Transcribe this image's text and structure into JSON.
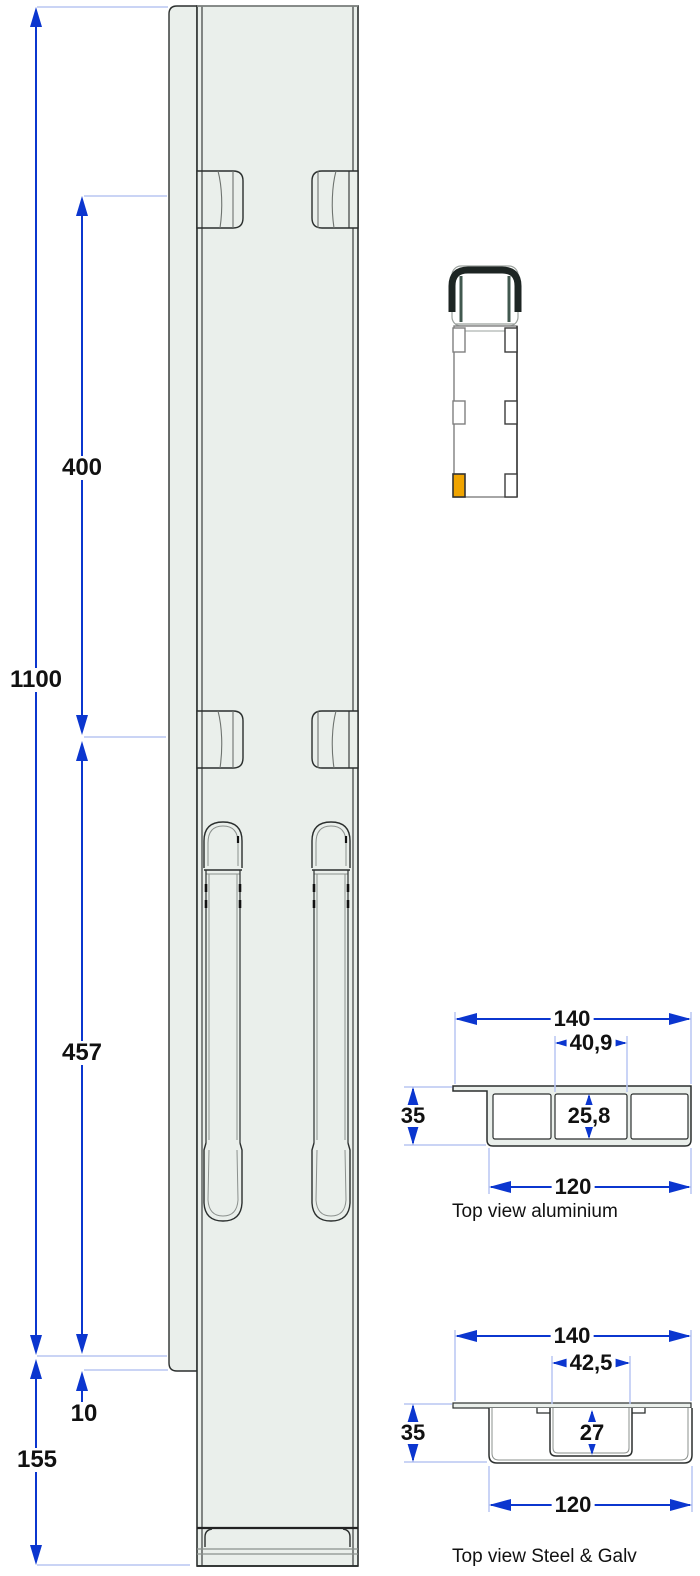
{
  "colors": {
    "dimension_blue": "#0b36cf",
    "extension_blue": "#b9c6f2",
    "outline_dark": "#2b2f2e",
    "outline_gray": "#8b908d",
    "panel_fill": "#eaefeb",
    "truck_frame_dark": "#1d2523",
    "truck_pillar_teal": "#41584f",
    "highlight_orange": "#f0a400"
  },
  "side_view": {
    "dims": {
      "overall": "1100",
      "upper": "400",
      "lower": "457",
      "offset": "10",
      "base": "155"
    }
  },
  "sections": {
    "aluminium": {
      "caption": "Top view aluminium",
      "dims": {
        "width": "140",
        "slot": "40,9",
        "height": "35",
        "inner": "25,8",
        "body": "120"
      }
    },
    "steel": {
      "caption": "Top view Steel & Galv",
      "dims": {
        "width": "140",
        "slot": "42,5",
        "height": "35",
        "inner": "27",
        "body": "120"
      }
    }
  }
}
